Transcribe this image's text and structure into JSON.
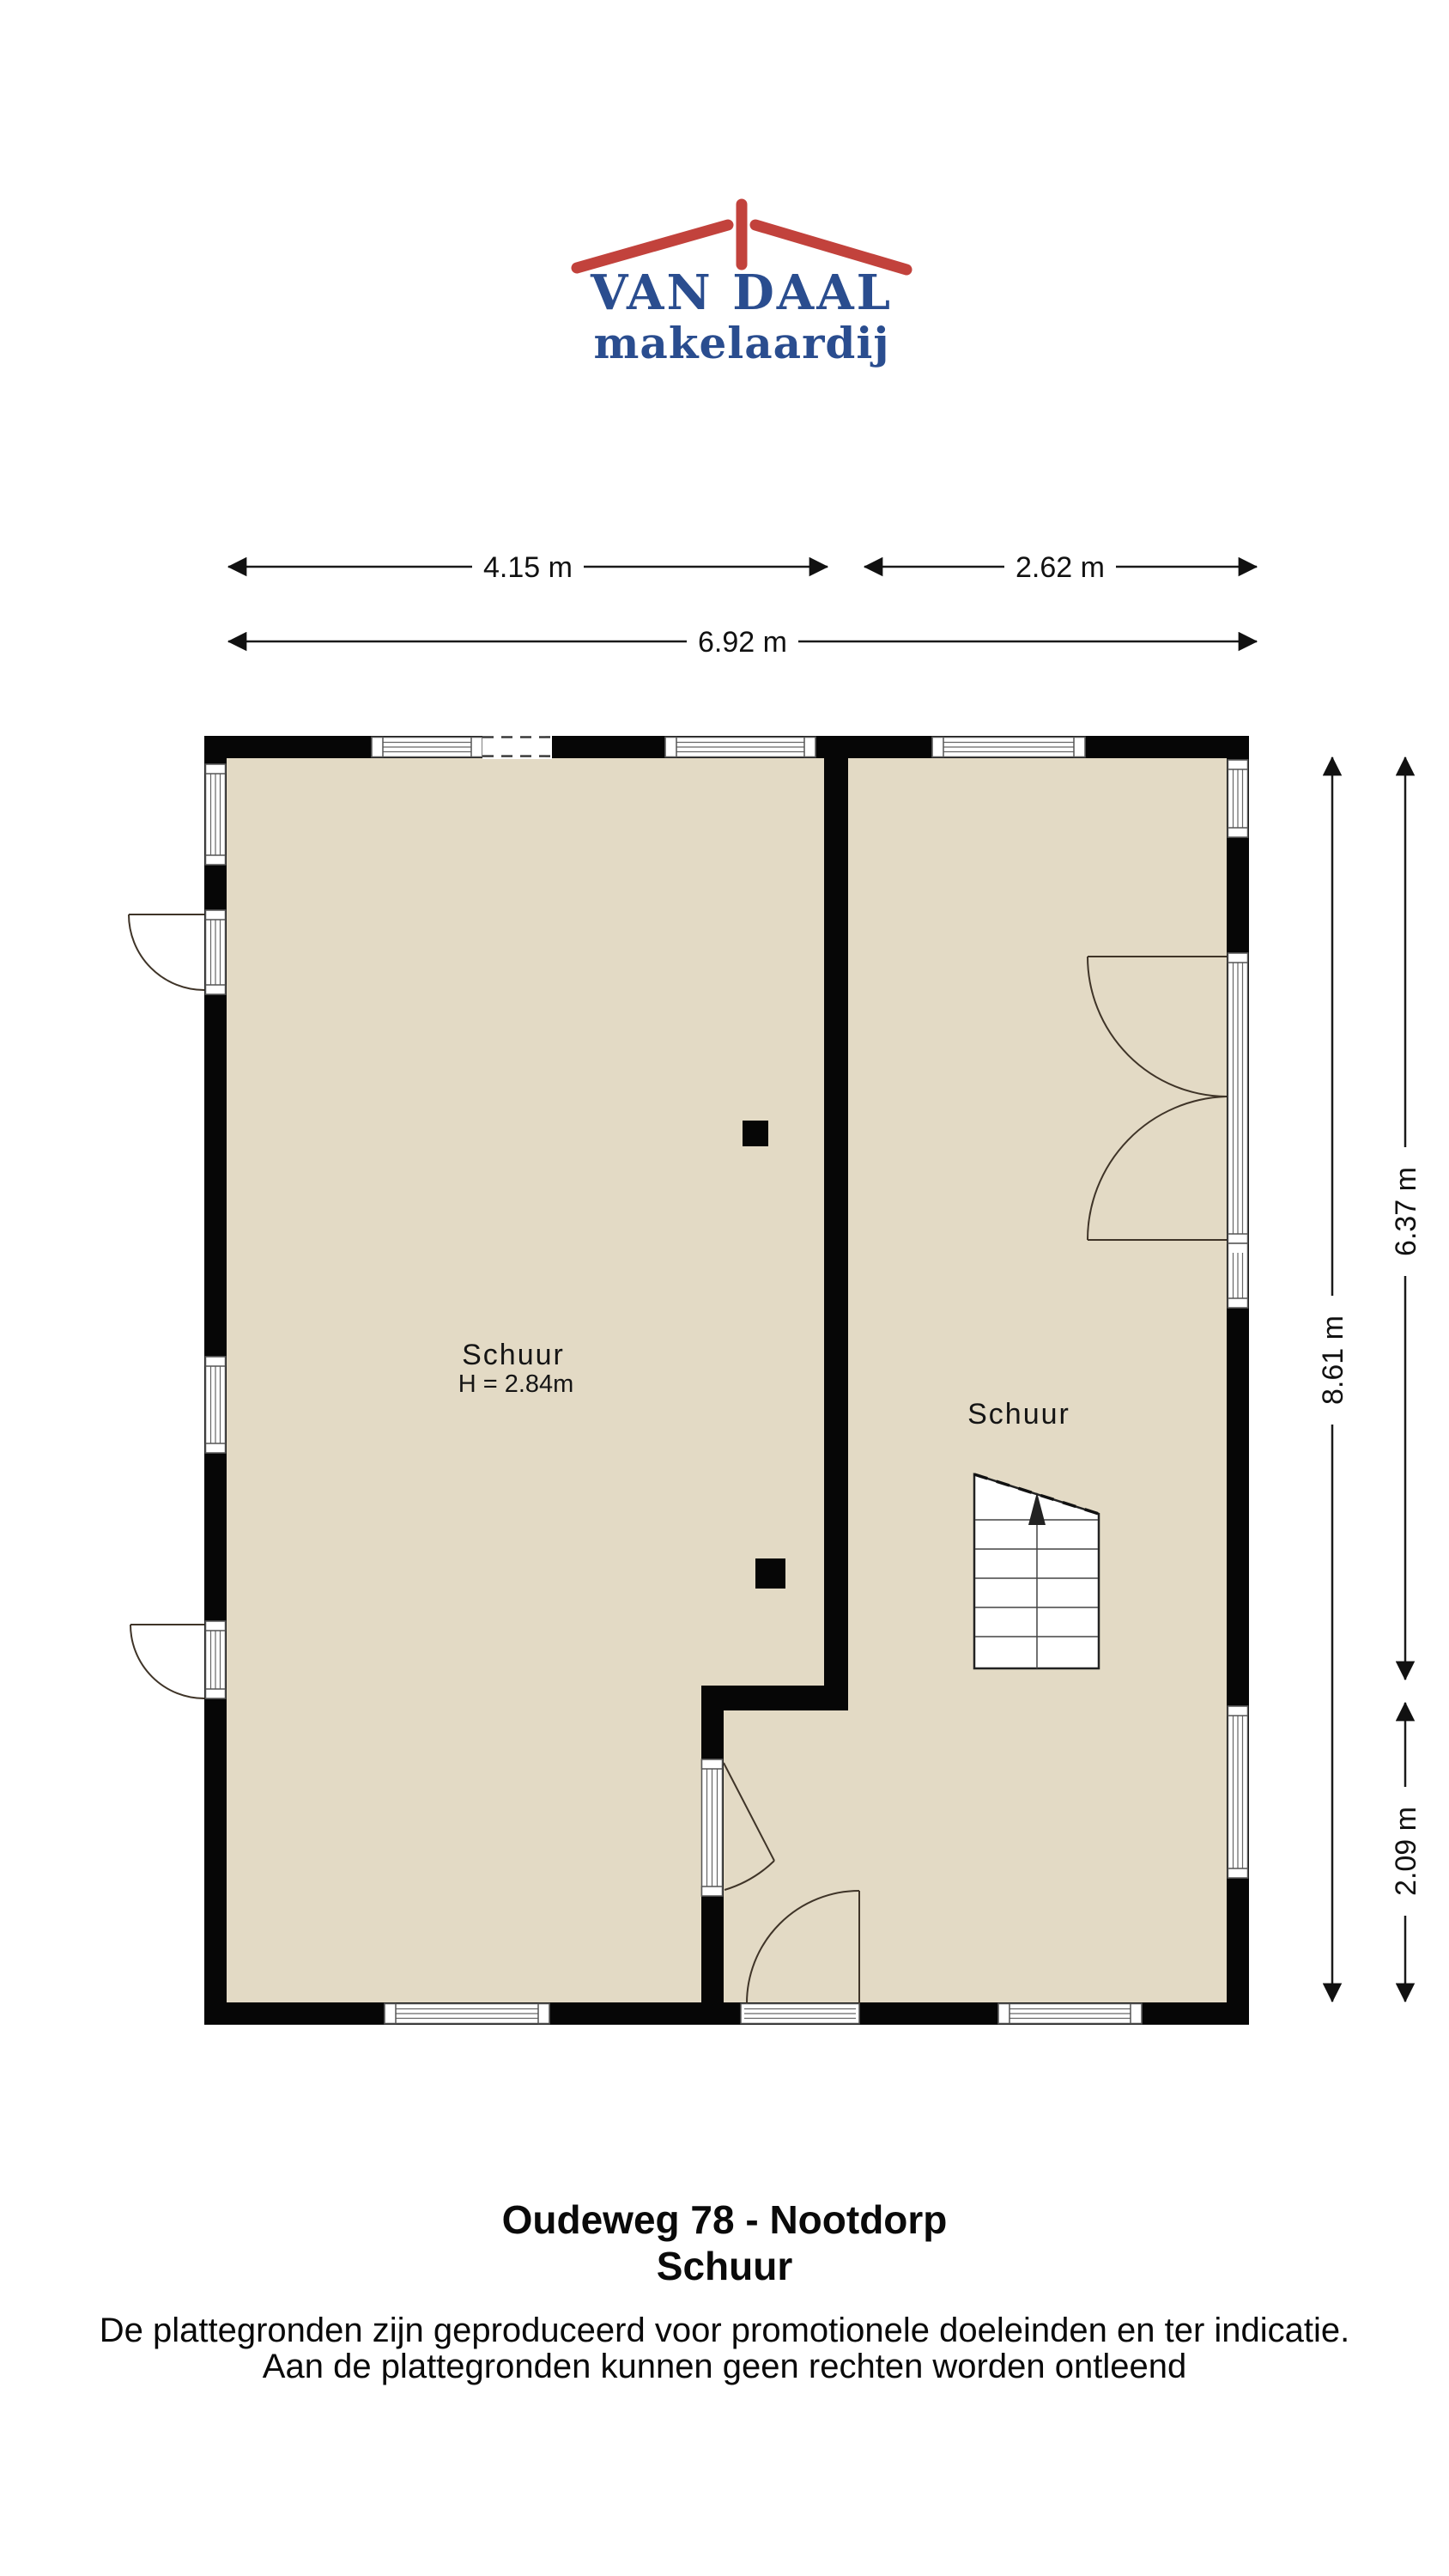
{
  "logo": {
    "line1": "VAN DAAL",
    "line2": "makelaardij",
    "roof_color": "#c2423c",
    "text_color": "#2a4d8f"
  },
  "dimensions": {
    "top_left": "4.15 m",
    "top_right": "2.62 m",
    "top_total": "6.92 m",
    "right_full": "8.61 m",
    "right_upper": "6.37 m",
    "right_lower": "2.09 m"
  },
  "rooms": {
    "left": {
      "name": "Schuur",
      "height": "H = 2.84m"
    },
    "right": {
      "name": "Schuur"
    }
  },
  "plan": {
    "floor_color": "#e3dac5",
    "wall_color": "#060606"
  },
  "footer": {
    "title": "Oudeweg 78 - Nootdorp",
    "subtitle": "Schuur",
    "disclaimer1": "De plattegronden zijn geproduceerd voor promotionele doeleinden en ter indicatie.",
    "disclaimer2": "Aan de plattegronden kunnen geen rechten worden ontleend"
  }
}
